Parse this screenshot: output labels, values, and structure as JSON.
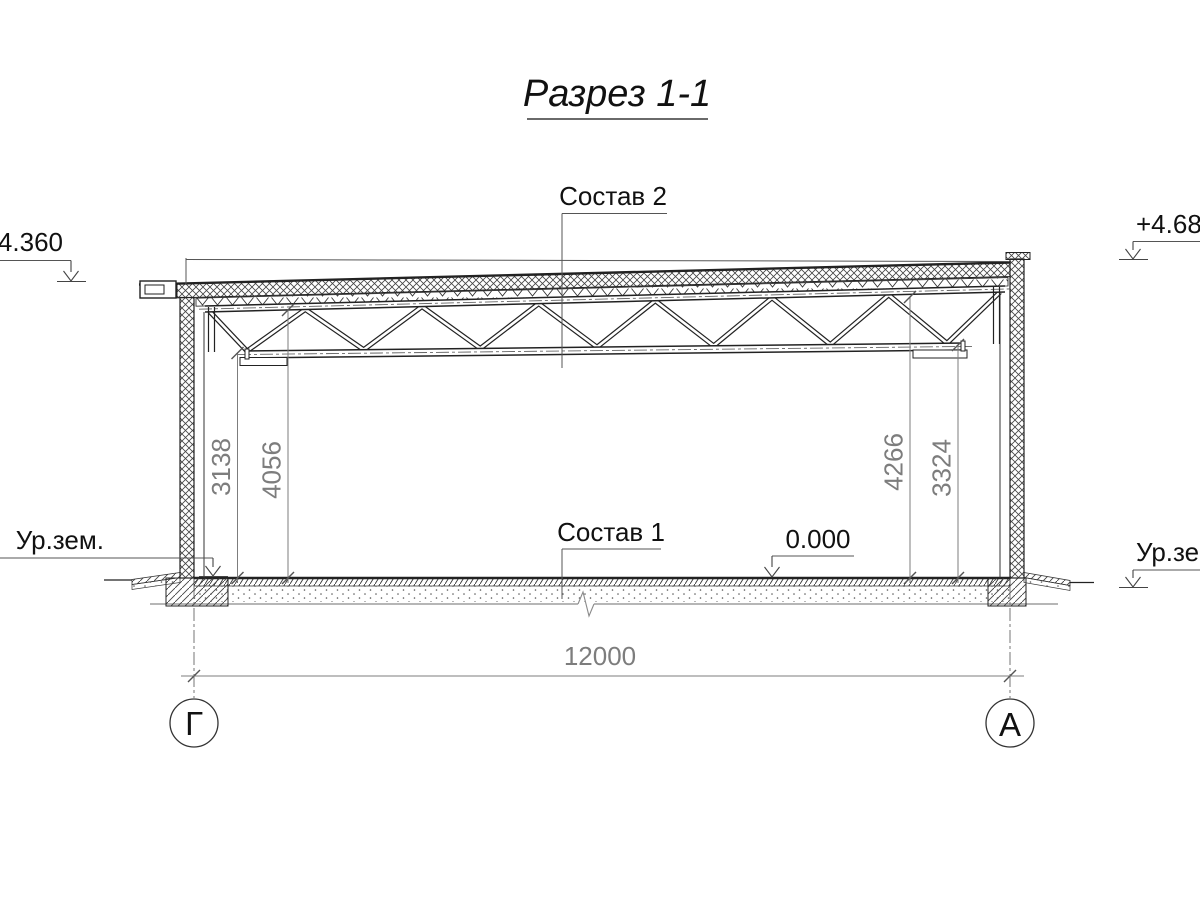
{
  "title": "Разрез 1-1",
  "labels": {
    "sostav2": "Состав 2",
    "sostav1": "Состав 1",
    "zero_level": "0.000",
    "elev_left": "+4.360",
    "elev_right": "+4.680",
    "ground_left": "Ур.зем.",
    "ground_right": "Ур.зем."
  },
  "dimensions": {
    "left_to_bottom_chord": "3138",
    "left_to_top_chord": "4056",
    "right_to_top_chord": "4266",
    "right_to_bottom_chord": "3324",
    "span": "12000"
  },
  "axes": {
    "left_letter": "Г",
    "right_letter": "А"
  },
  "colors": {
    "line": "#222222",
    "dimension": "#7d7d7d",
    "background": "#ffffff"
  }
}
